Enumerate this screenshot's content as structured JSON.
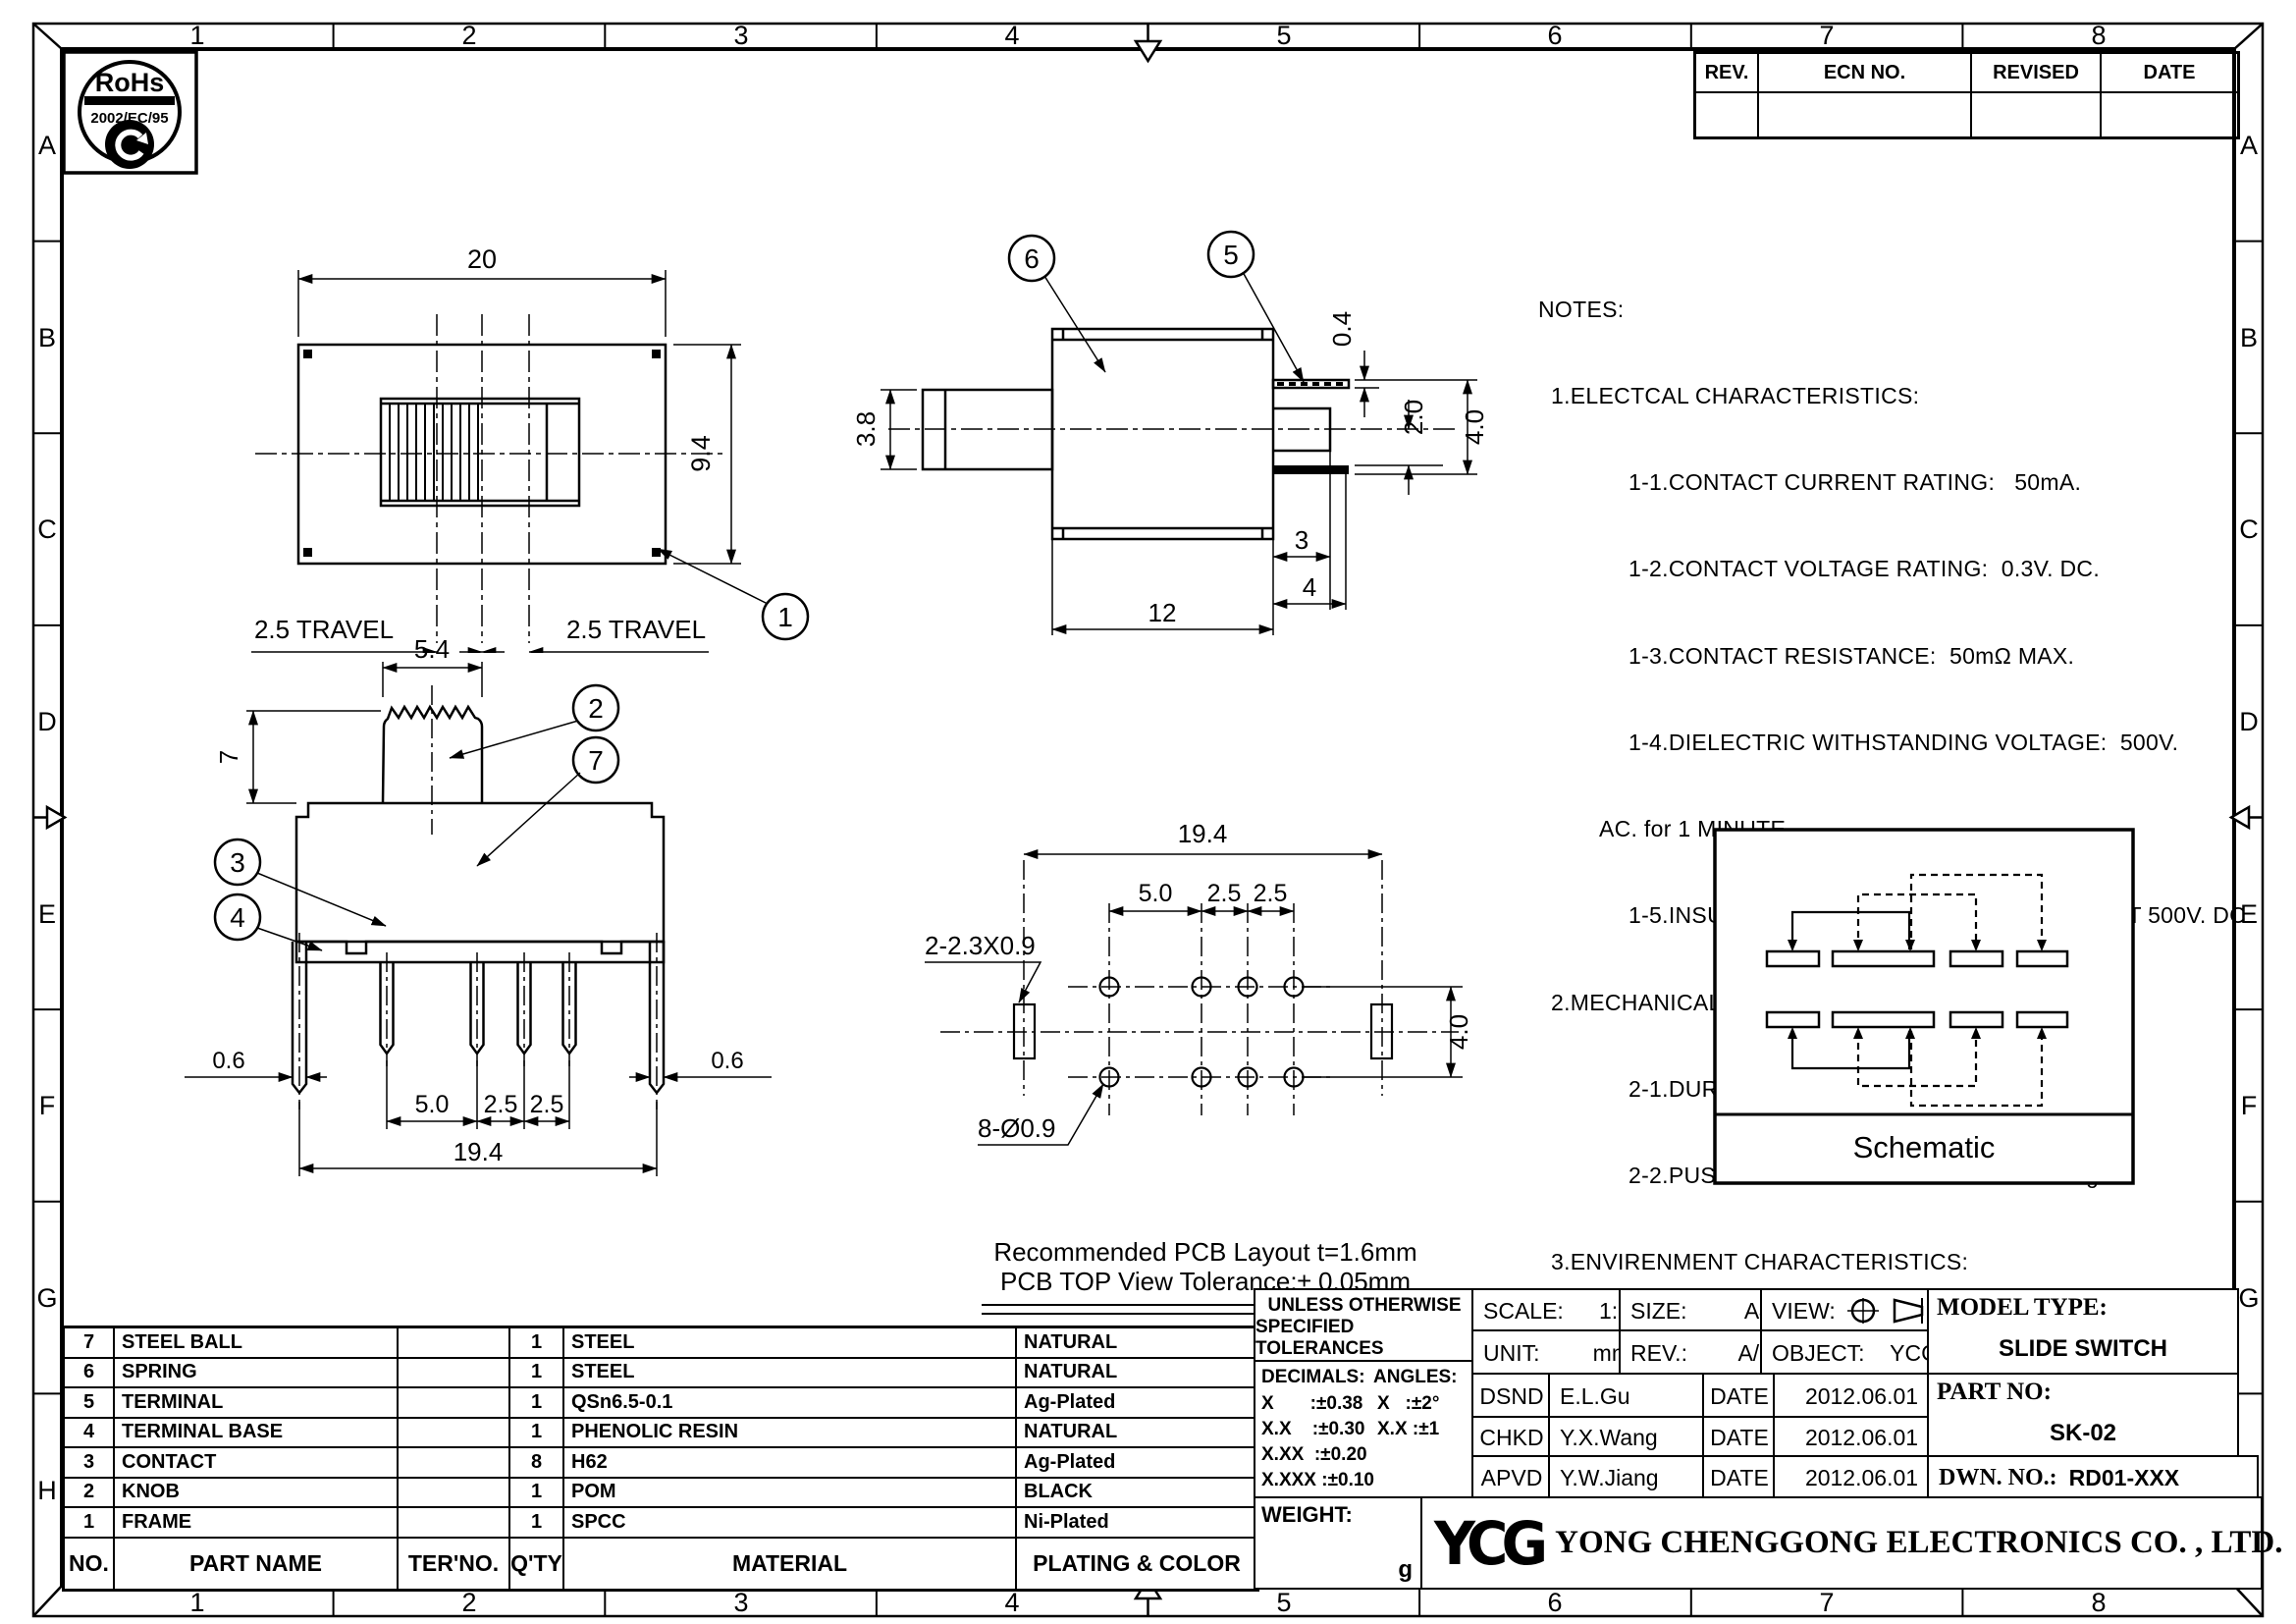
{
  "border": {
    "cols": [
      "1",
      "2",
      "3",
      "4",
      "5",
      "6",
      "7",
      "8"
    ],
    "rows": [
      "A",
      "B",
      "C",
      "D",
      "E",
      "F",
      "G",
      "H"
    ]
  },
  "rohs": {
    "title": "RoHs",
    "subtitle": "2002/EC/95"
  },
  "revision_table": {
    "headers": [
      "REV.",
      "ECN NO.",
      "REVISED",
      "DATE"
    ]
  },
  "notes": {
    "lines": [
      "NOTES:",
      "1.ELECTCAL CHARACTERISTICS:",
      "1-1.CONTACT CURRENT RATING:   50mA.",
      "1-2.CONTACT VOLTAGE RATING:  0.3V. DC.",
      "1-3.CONTACT RESISTANCE:  50mΩ MAX.",
      "1-4.DIELECTRIC WITHSTANDING VOLTAGE:  500V.",
      "AC. for 1 MINUTE",
      "1-5.INSULATION RESISTANCE:  100 MΩ MIN.AT 500V. DC",
      "2.MECHANICAL CHARACTERISTICS:",
      "2-1.DURABILITY:  10000 CYCLES.",
      "2-2.PUSH AND RETURN FORCE:  200~400gf.",
      "3.ENVIRENMENT CHARACTERISTICS:",
      "3-1.OPERATING TEMPERATURE.-25℃~+85℃",
      "3-2.HUMIDTY:45-85% RH."
    ]
  },
  "views": {
    "top": {
      "dim_width": "20",
      "dim_height": "9.4",
      "travel_left": "2.5 TRAVEL",
      "travel_right": "2.5 TRAVEL",
      "balloon_frame": "1"
    },
    "side": {
      "dim_stem": "3.8",
      "dim_t1": "0.4",
      "dim_t2": "2.0",
      "dim_t3": "4.0",
      "dim_step": "3",
      "dim_term": "4",
      "dim_body": "12",
      "balloon_spring": "6",
      "balloon_terminal": "5"
    },
    "front": {
      "dim_knob_w": "5.4",
      "dim_knob_h": "7",
      "dim_lug_l": "0.6",
      "dim_lug_r": "0.6",
      "dim_p1": "5.0",
      "dim_p2": "2.5",
      "dim_p3": "2.5",
      "dim_span": "19.4",
      "balloon_knob": "2",
      "balloon_cover": "7",
      "balloon_contact": "3",
      "balloon_base": "4"
    },
    "pcb": {
      "dim_span": "19.4",
      "dim_p1": "5.0",
      "dim_p2": "2.5",
      "dim_p3": "2.5",
      "dim_rows": "4.0",
      "slot_label": "2-2.3X0.9",
      "hole_label": "8-Ø0.9",
      "caption1": "Recommended PCB Layout t=1.6mm",
      "caption2": "PCB TOP View Tolerance:± 0.05mm"
    },
    "schematic": {
      "caption": "Schematic"
    }
  },
  "parts_table": {
    "headers": {
      "no": "NO.",
      "part_name": "PART NAME",
      "ter_no": "TER'NO.",
      "qty": "Q'TY",
      "material": "MATERIAL",
      "plating": "PLATING & COLOR"
    },
    "rows": [
      {
        "no": "7",
        "name": "STEEL BALL",
        "ter": "",
        "qty": "1",
        "material": "STEEL",
        "plating": "NATURAL"
      },
      {
        "no": "6",
        "name": "SPRING",
        "ter": "",
        "qty": "1",
        "material": "STEEL",
        "plating": "NATURAL"
      },
      {
        "no": "5",
        "name": "TERMINAL",
        "ter": "",
        "qty": "1",
        "material": "QSn6.5-0.1",
        "plating": "Ag-Plated"
      },
      {
        "no": "4",
        "name": "TERMINAL BASE",
        "ter": "",
        "qty": "1",
        "material": "PHENOLIC RESIN",
        "plating": "NATURAL"
      },
      {
        "no": "3",
        "name": "CONTACT",
        "ter": "",
        "qty": "8",
        "material": "H62",
        "plating": "Ag-Plated"
      },
      {
        "no": "2",
        "name": "KNOB",
        "ter": "",
        "qty": "1",
        "material": "POM",
        "plating": "BLACK"
      },
      {
        "no": "1",
        "name": "FRAME",
        "ter": "",
        "qty": "1",
        "material": "SPCC",
        "plating": "Ni-Plated"
      }
    ]
  },
  "title_block": {
    "tolerance_header1": "UNLESS OTHERWISE",
    "tolerance_header2": "SPECIFIED TOLERANCES",
    "decimals_label": "DECIMALS:",
    "angles_label": "ANGLES:",
    "dec_rows": [
      "X       :±0.38",
      "X.X    :±0.30",
      "X.XX  :±0.20",
      "X.XXX :±0.10"
    ],
    "ang_rows": [
      "X   :±2°",
      "X.X :±1"
    ],
    "scale_label": "SCALE:",
    "scale_value": "1:1",
    "size_label": "SIZE:",
    "size_value": "A4",
    "view_label": "VIEW:",
    "unit_label": "UNIT:",
    "unit_value": "mm",
    "rev_label": "REV.:",
    "rev_value": "A/0",
    "object_label": "OBJECT:",
    "object_value": "YCG",
    "model_type_label": "MODEL TYPE:",
    "model_type_value": "SLIDE SWITCH",
    "part_no_label": "PART NO:",
    "part_no_value": "SK-02",
    "dwn_no_label": "DWN. NO.:",
    "dwn_no_value": "RD01-XXX",
    "sign_rows": [
      {
        "role": "DSND",
        "name": "E.L.Gu",
        "date_label": "DATE",
        "date": "2012.06.01"
      },
      {
        "role": "CHKD",
        "name": "Y.X.Wang",
        "date_label": "DATE",
        "date": "2012.06.01"
      },
      {
        "role": "APVD",
        "name": "Y.W.Jiang",
        "date_label": "DATE",
        "date": "2012.06.01"
      }
    ],
    "weight_label": "WEIGHT:",
    "weight_unit": "g",
    "logo_text": "YCG",
    "company": "YONG CHENGGONG ELECTRONICS CO. , LTD."
  }
}
